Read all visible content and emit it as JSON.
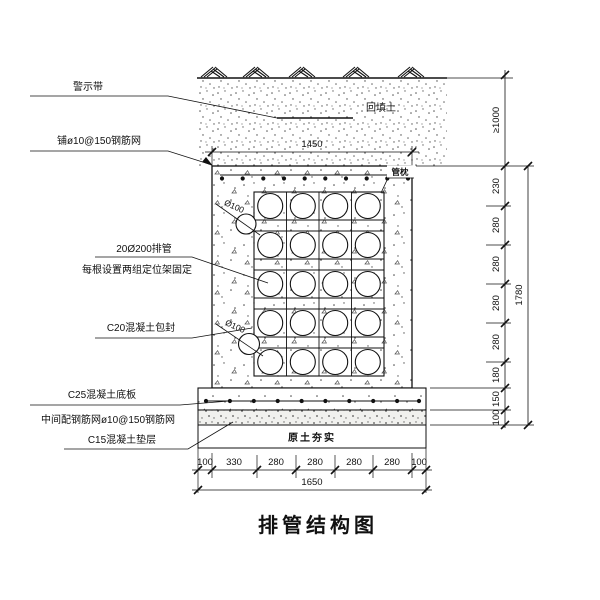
{
  "title": "排管结构图",
  "annotations": {
    "warning_tape": "警示带",
    "top_mesh": "铺ø10@150钢筋网",
    "pipe_bank_line1": "20Ø200排管",
    "pipe_bank_line2": "每根设置两组定位架固定",
    "encasement": "C20混凝土包封",
    "base_slab": "C25混凝土底板",
    "mid_mesh": "中间配钢筋网ø10@150钢筋网",
    "cushion": "C15混凝土垫层",
    "backfill": "回填土",
    "pipe_pillow": "管枕",
    "compacted_soil": "原土夯实",
    "small_pipe_dia_upper": "Ø100",
    "small_pipe_dia_lower": "Ø100"
  },
  "dimensions": {
    "top_width": "1450",
    "cover_depth": "≥1000",
    "right_chain": [
      "230",
      "280",
      "280",
      "280",
      "280",
      "180",
      "150",
      "100"
    ],
    "right_total": "1780",
    "bottom_chain": [
      "100",
      "330",
      "280",
      "280",
      "280",
      "280",
      "100"
    ],
    "bottom_total": "1650"
  },
  "structure": {
    "pipe_rows": 5,
    "pipe_cols": 4,
    "pipe_total": 20
  },
  "colors": {
    "line": "#111111",
    "stipple": "#555555",
    "background": "#ffffff"
  }
}
